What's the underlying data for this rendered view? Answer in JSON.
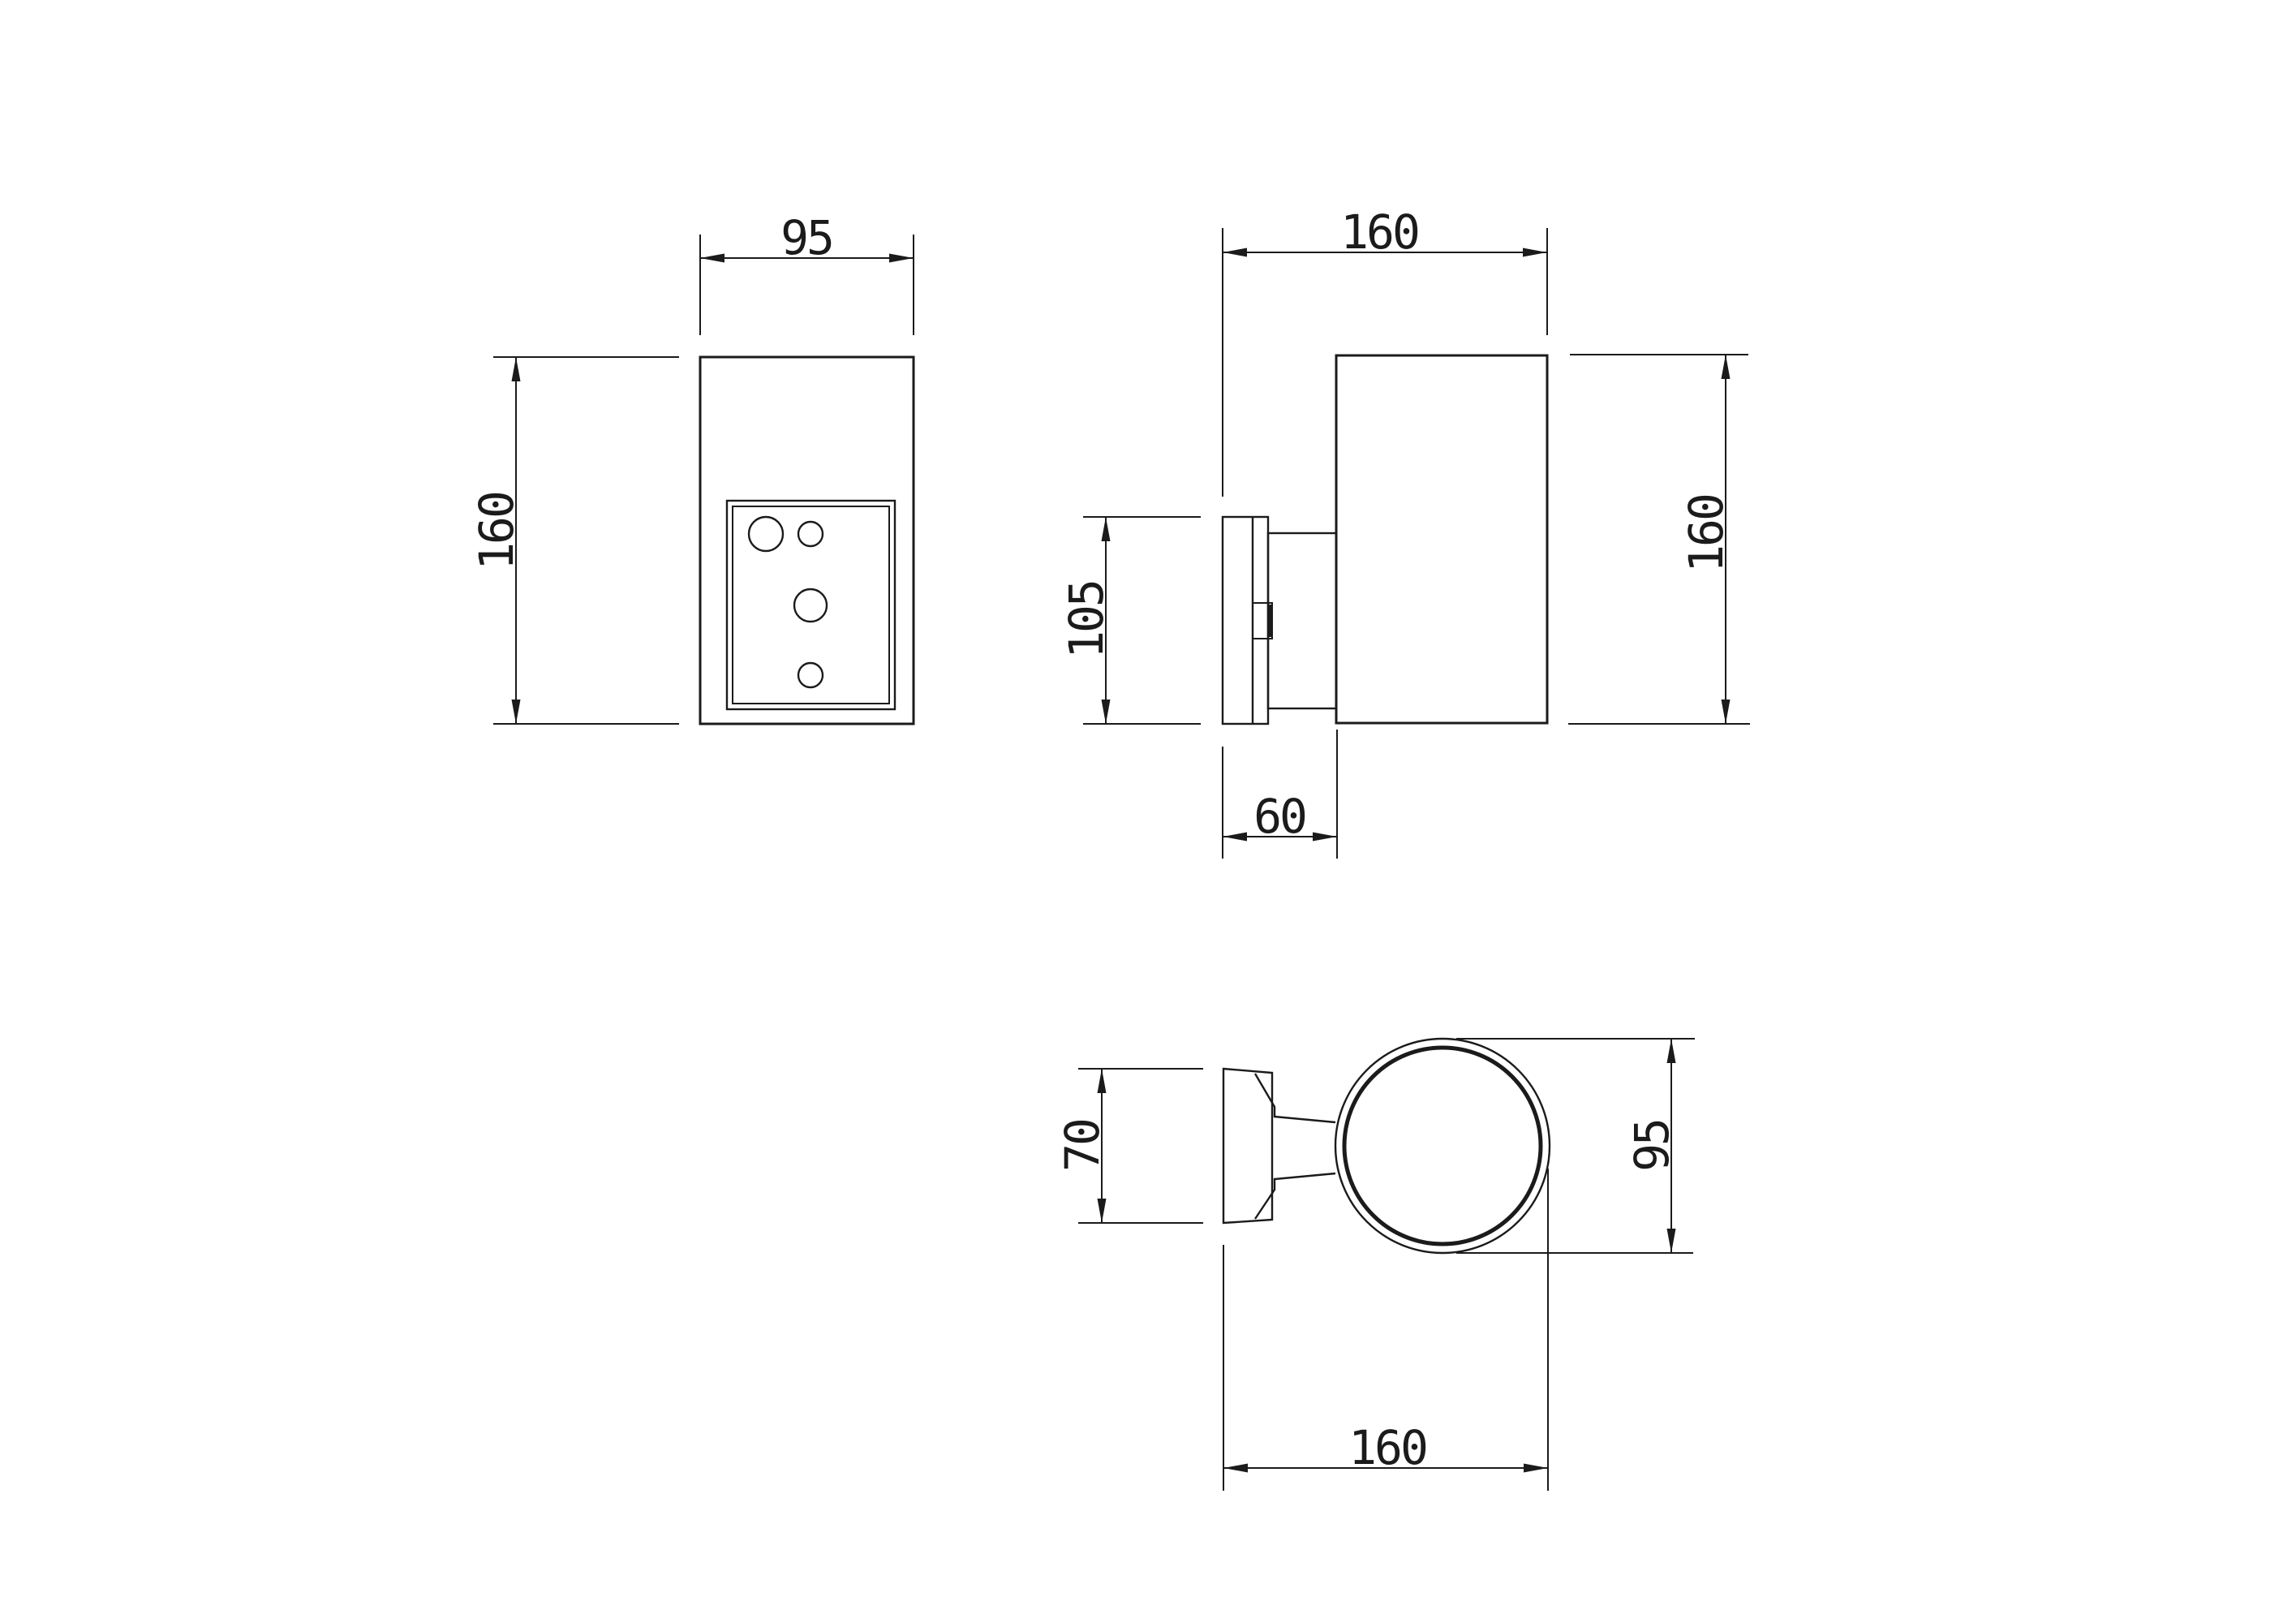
{
  "colors": {
    "line": "#1b1b1b",
    "background": "#ffffff"
  },
  "views": {
    "front": {
      "width": "95",
      "height": "160"
    },
    "side": {
      "depth": "160",
      "height": "160",
      "bracket_height": "105",
      "bracket_depth": "60"
    },
    "top": {
      "bracket_width": "70",
      "diameter": "95",
      "depth": "160"
    }
  }
}
